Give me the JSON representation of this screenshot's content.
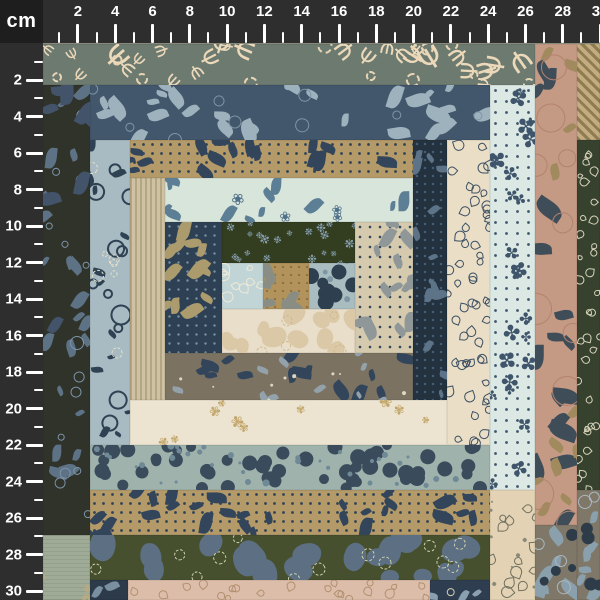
{
  "title": "Patchwork quilt fabric panel with centimeter ruler",
  "ruler": {
    "unit": "cm",
    "bg_color": "#2e2e2e",
    "corner_bg": "#1e1e1e",
    "ink_color": "#ffffff",
    "size_px": 43,
    "top": {
      "origin": 40.6,
      "step": 18.65,
      "max_cm": 30,
      "labels": [
        2,
        4,
        6,
        8,
        10,
        12,
        14,
        16,
        18,
        20,
        22,
        24,
        26,
        28,
        30
      ]
    },
    "left": {
      "origin": 43.5,
      "step": 18.25,
      "max_cm": 30,
      "labels": [
        2,
        4,
        6,
        8,
        10,
        12,
        14,
        16,
        18,
        20,
        22,
        24,
        26,
        28,
        30
      ]
    }
  },
  "fabrics": {
    "coral": {
      "name": "slate-green coral branches with stitched rings",
      "base": "#6d7a70",
      "layers": [
        {
          "t": "glyph",
          "g": "Ψ",
          "c": "#ecd9ba",
          "s": 22,
          "v": 8,
          "d": 13,
          "rot": 360
        },
        {
          "t": "ring",
          "c": "#e7d5b6",
          "s": 12,
          "v": 3,
          "d": 6,
          "b": 2,
          "dash": true
        }
      ]
    },
    "bluefloral": {
      "name": "slate blue butterfly floral",
      "base": "#42576b",
      "layers": [
        {
          "t": "petal",
          "c": "#9db2bd",
          "s": 18,
          "v": 8,
          "d": 13
        },
        {
          "t": "ring",
          "c": "#7e95a6",
          "s": 14,
          "v": 6,
          "d": 4,
          "b": 1
        }
      ]
    },
    "tanleaf": {
      "name": "tan with navy leaves and pin dots",
      "base": "#b49a69",
      "dotbg": {
        "c": "#2e4257",
        "r": 1.1,
        "sp": 9
      },
      "layers": [
        {
          "t": "petal",
          "c": "#32455b",
          "s": 16,
          "v": 6,
          "d": 16
        }
      ]
    },
    "mintfloral": {
      "name": "pale mint blue floral sprays",
      "base": "#d8e5da",
      "layers": [
        {
          "t": "petal",
          "c": "#5d7f95",
          "s": 15,
          "v": 6,
          "d": 11
        },
        {
          "t": "glyph",
          "g": "❀",
          "c": "#4f7189",
          "s": 13,
          "v": 4,
          "d": 4,
          "rot": 360
        }
      ]
    },
    "olivesprig": {
      "name": "dark olive with blue sprig flowers",
      "base": "#333d1f",
      "layers": [
        {
          "t": "glyph",
          "g": "❉",
          "c": "#87a0b1",
          "s": 10,
          "v": 3,
          "d": 38,
          "rot": 360
        }
      ]
    },
    "ltblueleaf": {
      "name": "light blue with cream leaf outlines",
      "base": "#c2d5d6",
      "layers": [
        {
          "t": "tear",
          "c": "#efe9d6",
          "s": 9,
          "v": 3,
          "d": 48,
          "b": 1.5
        }
      ]
    },
    "centerleaf": {
      "name": "camel center square with gray leaf",
      "base": "#b2935c",
      "dotbg": {
        "c": "#8a6f3e",
        "r": 0.8,
        "sp": 8
      },
      "layers": [
        {
          "t": "petal",
          "c": "#8a8d84",
          "s": 17,
          "v": 5,
          "d": 28
        }
      ]
    },
    "plums": {
      "name": "blue-gray plum dots square",
      "base": "#a9bdc1",
      "layers": [
        {
          "t": "dot",
          "c": "#2e3f4f",
          "s": 13,
          "v": 3,
          "d": 40
        },
        {
          "t": "dot",
          "c": "#7d98a4",
          "s": 5,
          "v": 2,
          "d": 20
        }
      ]
    },
    "creamstitch": {
      "name": "cream tone-on-tone stitched floral",
      "base": "#e8dec9",
      "layers": [
        {
          "t": "blob",
          "c": "#dac8a7",
          "s": 19,
          "v": 6,
          "d": 22
        },
        {
          "t": "ring",
          "c": "#cdb98f",
          "s": 11,
          "v": 3,
          "d": 8,
          "b": 1.5,
          "dash": true
        }
      ]
    },
    "navytanleaf": {
      "name": "navy with tan leaves",
      "base": "#2e4154",
      "dotbg": {
        "c": "#76909f",
        "r": 0.9,
        "sp": 9
      },
      "layers": [
        {
          "t": "petal",
          "c": "#ab9b6d",
          "s": 18,
          "v": 6,
          "d": 18
        }
      ]
    },
    "beigeleaf": {
      "name": "beige with gray leaves and navy dots",
      "base": "#d5caae",
      "dotbg": {
        "c": "#31445a",
        "r": 1.0,
        "sp": 10
      },
      "layers": [
        {
          "t": "petal",
          "c": "#8f9798",
          "s": 16,
          "v": 6,
          "d": 18
        }
      ]
    },
    "woven": {
      "name": "beige woven stripe texture",
      "base": "#cec2a3",
      "stripebg": {
        "c": "#b3a685",
        "w": 2,
        "gap": 3,
        "ang": 90
      }
    },
    "navyslate": {
      "name": "dark navy with slate leaves",
      "base": "#24323f",
      "dotbg": {
        "c": "#46607a",
        "r": 0.9,
        "sp": 8
      },
      "layers": [
        {
          "t": "petal",
          "c": "#5d7488",
          "s": 13,
          "v": 5,
          "d": 17
        }
      ]
    },
    "creamleafy": {
      "name": "cream with navy leaf outlines",
      "base": "#eadfc6",
      "layers": [
        {
          "t": "tear",
          "c": "#3c4f63",
          "s": 9,
          "v": 2,
          "d": 42,
          "b": 1.5
        }
      ]
    },
    "mintmaple": {
      "name": "mint with navy maple leaves and dots",
      "base": "#dbe8e3",
      "dotbg": {
        "c": "#3e556b",
        "r": 1.1,
        "sp": 11
      },
      "layers": [
        {
          "t": "glyph",
          "g": "✤",
          "c": "#3f556b",
          "s": 18,
          "v": 6,
          "d": 13,
          "rot": 360
        }
      ]
    },
    "ltpaisley": {
      "name": "light blue paisley medallion",
      "base": "#a8bbc2",
      "layers": [
        {
          "t": "ring",
          "c": "#2f4254",
          "s": 16,
          "v": 6,
          "d": 9,
          "b": 2
        },
        {
          "t": "petal",
          "c": "#2f4254",
          "s": 10,
          "v": 4,
          "d": 11
        },
        {
          "t": "ring",
          "c": "#e9e1c8",
          "s": 9,
          "v": 3,
          "d": 6,
          "b": 1.5,
          "dash": true
        }
      ]
    },
    "olivepaisley": {
      "name": "dark olive paisley floral",
      "base": "#2f332a",
      "layers": [
        {
          "t": "petal",
          "c": "#5d7285",
          "s": 15,
          "v": 6,
          "d": 11
        },
        {
          "t": "ring",
          "c": "#7d93a8",
          "s": 10,
          "v": 4,
          "d": 6,
          "b": 1.5
        },
        {
          "t": "petal",
          "c": "#42536a",
          "s": 21,
          "v": 6,
          "d": 4
        }
      ]
    },
    "salmon": {
      "name": "salmon large floral with swirls",
      "base": "#c49a85",
      "layers": [
        {
          "t": "petal",
          "c": "#3f4d59",
          "s": 21,
          "v": 8,
          "d": 8
        },
        {
          "t": "petal",
          "c": "#a08a5e",
          "s": 13,
          "v": 5,
          "d": 6
        },
        {
          "t": "ring",
          "c": "#b2836c",
          "s": 25,
          "v": 8,
          "d": 5,
          "b": 1
        }
      ]
    },
    "dkgreenleaf": {
      "name": "dark green with cream leaf outlines",
      "base": "#36422e",
      "layers": [
        {
          "t": "tear",
          "c": "#d7d3bb",
          "s": 7,
          "v": 2,
          "d": 44,
          "b": 1.5
        }
      ]
    },
    "braid": {
      "name": "tan diagonal braid weave",
      "base": "#c3ac80",
      "stripebg": {
        "c": "#8f7c52",
        "w": 3,
        "gap": 4,
        "ang": 45
      }
    },
    "rose": {
      "name": "taupe with dusty blue roses",
      "base": "#7f7767",
      "layers": [
        {
          "t": "petal",
          "c": "#8ba0ad",
          "s": 18,
          "v": 6,
          "d": 22
        },
        {
          "t": "dot",
          "c": "#2e3c4a",
          "s": 10,
          "v": 4,
          "d": 14
        },
        {
          "t": "ring",
          "c": "#a9b8c0",
          "s": 14,
          "v": 5,
          "d": 8,
          "b": 1
        }
      ]
    },
    "pinecone": {
      "name": "taupe-brown pinecone floral",
      "base": "#7b7262",
      "layers": [
        {
          "t": "petal",
          "c": "#32455a",
          "s": 17,
          "v": 6,
          "d": 12
        },
        {
          "t": "petal",
          "c": "#93a1ab",
          "s": 11,
          "v": 4,
          "d": 9
        },
        {
          "t": "dot",
          "c": "#ded6c0",
          "s": 3,
          "v": 1,
          "d": 8
        }
      ]
    },
    "creamdoodle": {
      "name": "ivory with tan flower doodles",
      "base": "#ece4d1",
      "layers": [
        {
          "t": "glyph",
          "g": "✾",
          "c": "#c3a76a",
          "s": 13,
          "v": 4,
          "d": 7,
          "rot": 360
        }
      ]
    },
    "plumstrip": {
      "name": "gray-green plum dot strip",
      "base": "#9fb2ac",
      "layers": [
        {
          "t": "dot",
          "c": "#3a4b5c",
          "s": 13,
          "v": 3,
          "d": 30
        },
        {
          "t": "dot",
          "c": "#6f8a96",
          "s": 5,
          "v": 2,
          "d": 20
        }
      ]
    },
    "camo": {
      "name": "olive-blue camo with stitched rings",
      "base": "#46502f",
      "layers": [
        {
          "t": "blob",
          "c": "#5d6f82",
          "s": 24,
          "v": 8,
          "d": 13
        },
        {
          "t": "ring",
          "c": "#d2d5ae",
          "s": 11,
          "v": 2,
          "d": 7,
          "b": 1.5,
          "dash": true
        }
      ]
    },
    "sage": {
      "name": "sage green with tan doodles",
      "base": "#9fab97",
      "stripebg": {
        "c": "#93a08c",
        "w": 1,
        "gap": 3,
        "ang": 0
      },
      "layers": [
        {
          "t": "glyph",
          "g": "❁",
          "c": "#c2ab7a",
          "s": 13,
          "v": 3,
          "d": 10,
          "rot": 360
        }
      ]
    },
    "navybloom": {
      "name": "dark navy floral scrap",
      "base": "#2c3a4a",
      "layers": [
        {
          "t": "petal",
          "c": "#7a8fa0",
          "s": 11,
          "v": 4,
          "d": 30
        }
      ]
    },
    "pinkleaves": {
      "name": "dusty pink with leaf outlines",
      "base": "#dcbda9",
      "layers": [
        {
          "t": "tear",
          "c": "#b2906f",
          "s": 8,
          "v": 2,
          "d": 34,
          "b": 1.5
        }
      ]
    },
    "navypod": {
      "name": "navy pod floral scrap",
      "base": "#2e3d50",
      "layers": [
        {
          "t": "petal",
          "c": "#8aa0b0",
          "s": 11,
          "v": 3,
          "d": 26
        },
        {
          "t": "ring",
          "c": "#d8d2b8",
          "s": 8,
          "v": 2,
          "d": 12,
          "b": 1
        }
      ]
    },
    "beigepaisley": {
      "name": "beige with small paisley shapes",
      "base": "#e3d3b4",
      "layers": [
        {
          "t": "tear",
          "c": "#6f6f5f",
          "s": 10,
          "v": 3,
          "d": 26,
          "b": 1.5
        },
        {
          "t": "dot",
          "c": "#8a8a78",
          "s": 3,
          "v": 1,
          "d": 18
        }
      ]
    }
  },
  "patches": [
    {
      "f": "coral",
      "x": 43,
      "y": 44,
      "w": 492,
      "h": 41
    },
    {
      "f": "salmon",
      "x": 535,
      "y": 44,
      "w": 42,
      "h": 481
    },
    {
      "f": "braid",
      "x": 577,
      "y": 44,
      "w": 23,
      "h": 96
    },
    {
      "f": "dkgreenleaf",
      "x": 577,
      "y": 140,
      "w": 23,
      "h": 350
    },
    {
      "f": "rose",
      "x": 577,
      "y": 490,
      "w": 23,
      "h": 110
    },
    {
      "f": "rose",
      "x": 535,
      "y": 525,
      "w": 42,
      "h": 75
    },
    {
      "f": "olivepaisley",
      "x": 43,
      "y": 85,
      "w": 47,
      "h": 450
    },
    {
      "f": "sage",
      "x": 43,
      "y": 535,
      "w": 47,
      "h": 65
    },
    {
      "f": "bluefloral",
      "x": 90,
      "y": 85,
      "w": 400,
      "h": 55
    },
    {
      "f": "mintmaple",
      "x": 490,
      "y": 85,
      "w": 45,
      "h": 405
    },
    {
      "f": "beigepaisley",
      "x": 490,
      "y": 490,
      "w": 45,
      "h": 110
    },
    {
      "f": "ltpaisley",
      "x": 90,
      "y": 140,
      "w": 40,
      "h": 305
    },
    {
      "f": "tanleaf",
      "x": 130,
      "y": 140,
      "w": 283,
      "h": 38
    },
    {
      "f": "navyslate",
      "x": 413,
      "y": 140,
      "w": 34,
      "h": 260
    },
    {
      "f": "creamleafy",
      "x": 447,
      "y": 140,
      "w": 43,
      "h": 305
    },
    {
      "f": "woven",
      "x": 130,
      "y": 178,
      "w": 35,
      "h": 222
    },
    {
      "f": "mintfloral",
      "x": 165,
      "y": 178,
      "w": 248,
      "h": 44
    },
    {
      "f": "navytanleaf",
      "x": 165,
      "y": 222,
      "w": 57,
      "h": 131
    },
    {
      "f": "olivesprig",
      "x": 222,
      "y": 222,
      "w": 133,
      "h": 41
    },
    {
      "f": "beigeleaf",
      "x": 355,
      "y": 222,
      "w": 58,
      "h": 131
    },
    {
      "f": "ltblueleaf",
      "x": 222,
      "y": 263,
      "w": 41,
      "h": 46
    },
    {
      "f": "centerleaf",
      "x": 263,
      "y": 263,
      "w": 46,
      "h": 46
    },
    {
      "f": "plums",
      "x": 309,
      "y": 263,
      "w": 46,
      "h": 46
    },
    {
      "f": "creamstitch",
      "x": 222,
      "y": 309,
      "w": 133,
      "h": 44
    },
    {
      "f": "pinecone",
      "x": 165,
      "y": 353,
      "w": 248,
      "h": 47
    },
    {
      "f": "creamdoodle",
      "x": 130,
      "y": 400,
      "w": 317,
      "h": 45
    },
    {
      "f": "plumstrip",
      "x": 90,
      "y": 445,
      "w": 400,
      "h": 45
    },
    {
      "f": "tanleaf",
      "x": 90,
      "y": 490,
      "w": 400,
      "h": 45
    },
    {
      "f": "camo",
      "x": 90,
      "y": 535,
      "w": 400,
      "h": 45
    },
    {
      "f": "navybloom",
      "x": 90,
      "y": 580,
      "w": 38,
      "h": 20
    },
    {
      "f": "pinkleaves",
      "x": 128,
      "y": 580,
      "w": 302,
      "h": 20
    },
    {
      "f": "navypod",
      "x": 430,
      "y": 580,
      "w": 60,
      "h": 20
    }
  ]
}
